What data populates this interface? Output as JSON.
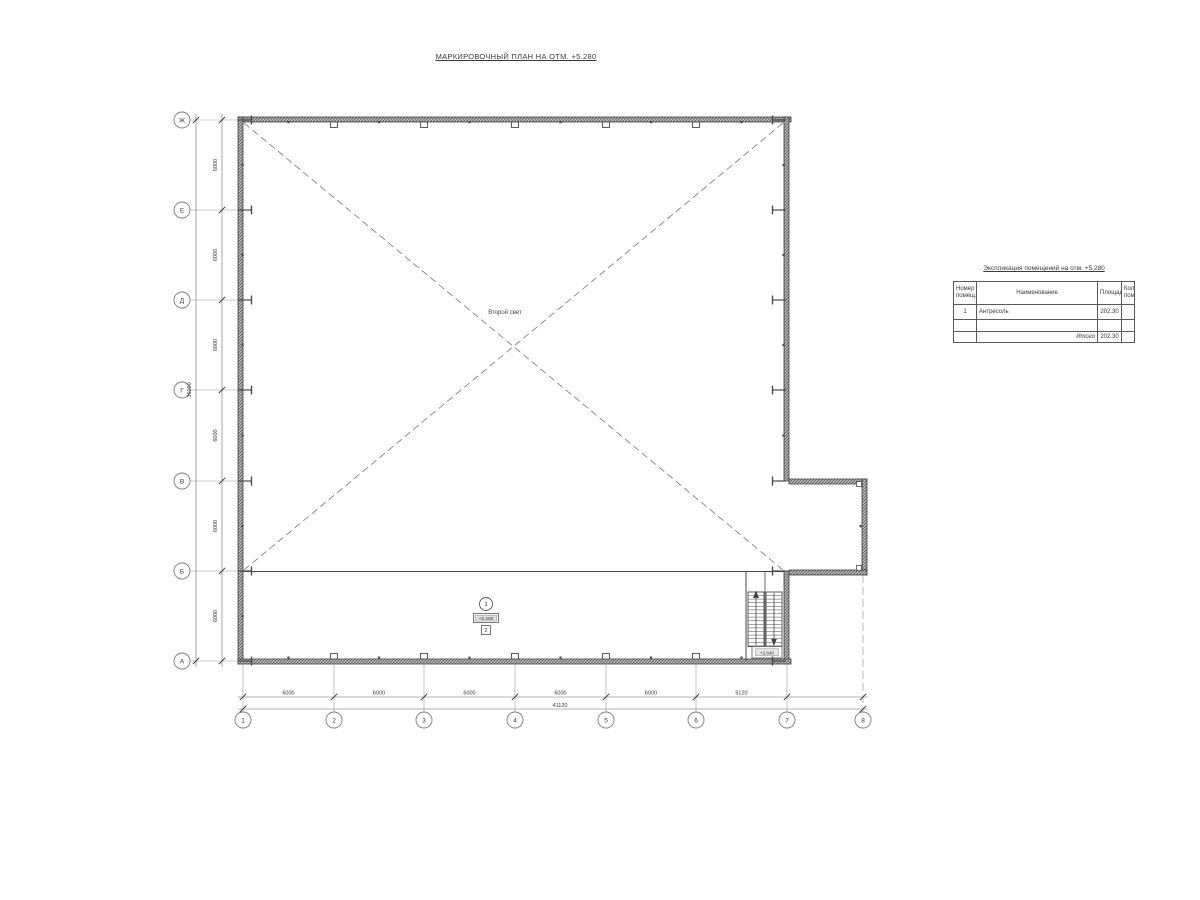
{
  "title": "МАРКИРОВОЧНЫЙ ПЛАН НА ОТМ. +5.280",
  "plan": {
    "void_label": "Второй свет",
    "room_marker": {
      "number": "1",
      "elevation": "+5.280",
      "finish_type": "2"
    },
    "stair_landing_elevation": "+2.640"
  },
  "axes": {
    "row_labels": [
      "Ж",
      "Е",
      "Д",
      "Г",
      "В",
      "Б",
      "А"
    ],
    "col_labels": [
      "1",
      "2",
      "3",
      "4",
      "5",
      "6",
      "7",
      "8"
    ]
  },
  "dimensions": {
    "row_spacing": [
      "6000",
      "6000",
      "6000",
      "6000",
      "6000",
      "6000"
    ],
    "row_total": "36000",
    "col_spacing": [
      "6000",
      "6000",
      "6000",
      "6000",
      "6000",
      "5120"
    ],
    "col_total": "41120"
  },
  "table": {
    "title": "Экспликация помещений на отм. +5.280",
    "headers": {
      "number": "Номер помещ.",
      "name": "Наименование",
      "area": "Площадь",
      "count": "Кол. пом."
    },
    "rows": [
      {
        "number": "1",
        "name": "Антресоль",
        "area": "202.30",
        "count": ""
      },
      {
        "number": "",
        "name": "",
        "area": "",
        "count": ""
      }
    ],
    "total_label": "Итого",
    "total_area": "202.30"
  },
  "colors": {
    "line": "#4a4a4a",
    "wall_edge": "#3f3f3f",
    "axis": "#999999",
    "dash": "#777777"
  }
}
